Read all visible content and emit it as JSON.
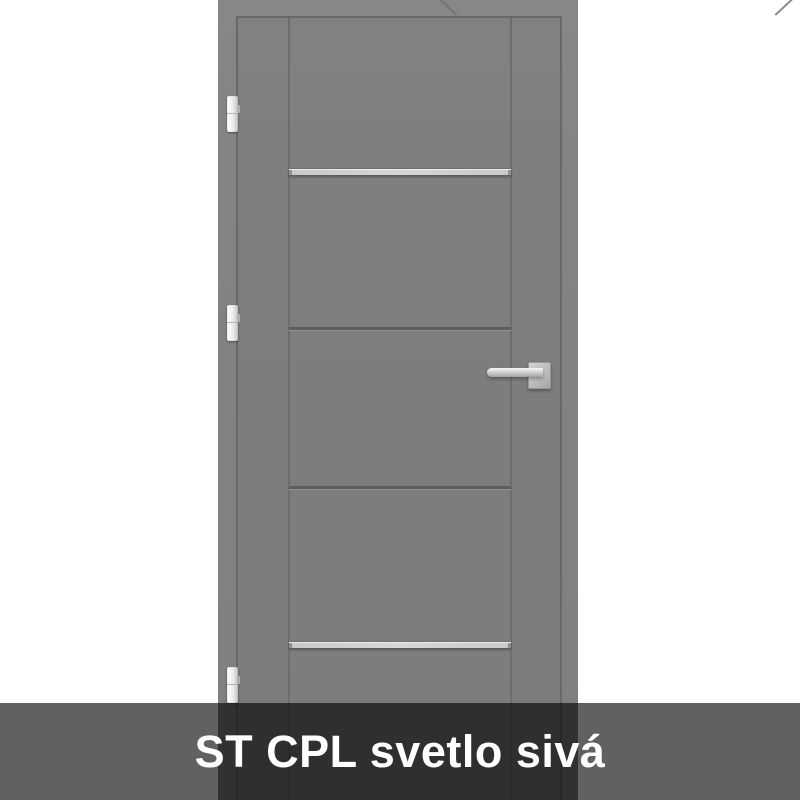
{
  "banner": {
    "label": "ST CPL svetlo sivá"
  },
  "door": {
    "description": "interior door with frame, light gray",
    "hinge_count": 3,
    "aluminium_strip_count": 2,
    "groove_count": 2
  },
  "colors": {
    "page_bg": "#ffffff",
    "frame": "#828482",
    "leaf": "#7d7f7d",
    "gap": "#676967",
    "seam": "#6e706e",
    "groove": "#6c6e6c",
    "groove_dark": "#5c5e5c",
    "strip": "#c8cac8",
    "metal": "#b4b6b4",
    "metal_dark": "#c0c2c0",
    "banner": "rgba(0,0,0,0.62)",
    "banner_text": "#ffffff"
  }
}
